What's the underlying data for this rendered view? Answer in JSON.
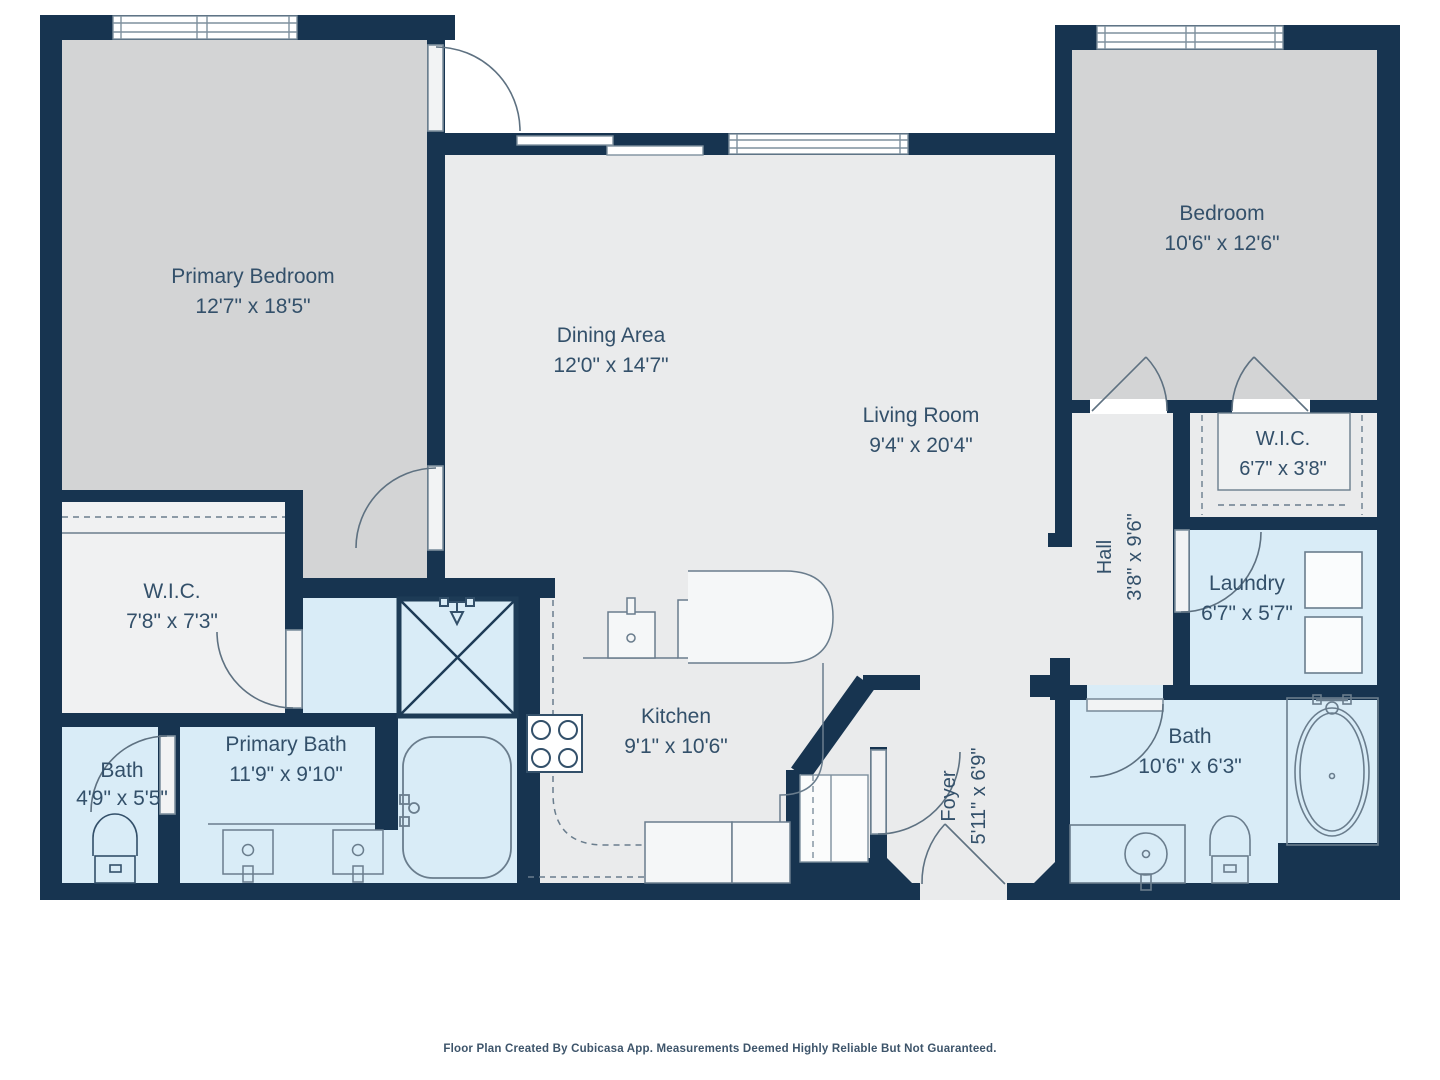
{
  "title": "Floor Plan",
  "rooms": {
    "primary_bedroom": {
      "name": "Primary Bedroom",
      "dims": "12'7\" x 18'5\""
    },
    "dining_area": {
      "name": "Dining Area",
      "dims": "12'0\" x 14'7\""
    },
    "living_room": {
      "name": "Living Room",
      "dims": "9'4\" x 20'4\""
    },
    "bedroom": {
      "name": "Bedroom",
      "dims": "10'6\" x 12'6\""
    },
    "wic_right": {
      "name": "W.I.C.",
      "dims": "6'7\" x 3'8\""
    },
    "hall": {
      "name": "Hall",
      "dims": "3'8\" x 9'6\""
    },
    "laundry": {
      "name": "Laundry",
      "dims": "6'7\" x 5'7\""
    },
    "bath_right": {
      "name": "Bath",
      "dims": "10'6\" x 6'3\""
    },
    "foyer": {
      "name": "Foyer",
      "dims": "5'11\" x 6'9\""
    },
    "kitchen": {
      "name": "Kitchen",
      "dims": "9'1\" x 10'6\""
    },
    "primary_bath": {
      "name": "Primary Bath",
      "dims": "11'9\" x 9'10\""
    },
    "bath_left": {
      "name": "Bath",
      "dims": "4'9\" x 5'5\""
    },
    "wic_left": {
      "name": "W.I.C.",
      "dims": "7'8\" x 7'3\""
    }
  },
  "footer": {
    "disclaimer": "Floor Plan Created By Cubicasa App. Measurements Deemed Highly Reliable But Not Guaranteed."
  },
  "colors": {
    "wall": "#173450",
    "bedroom_fill": "#d3d4d5",
    "living_fill": "#eaebec",
    "wet_room_fill": "#d9ecf7",
    "label_text": "#33506a"
  }
}
